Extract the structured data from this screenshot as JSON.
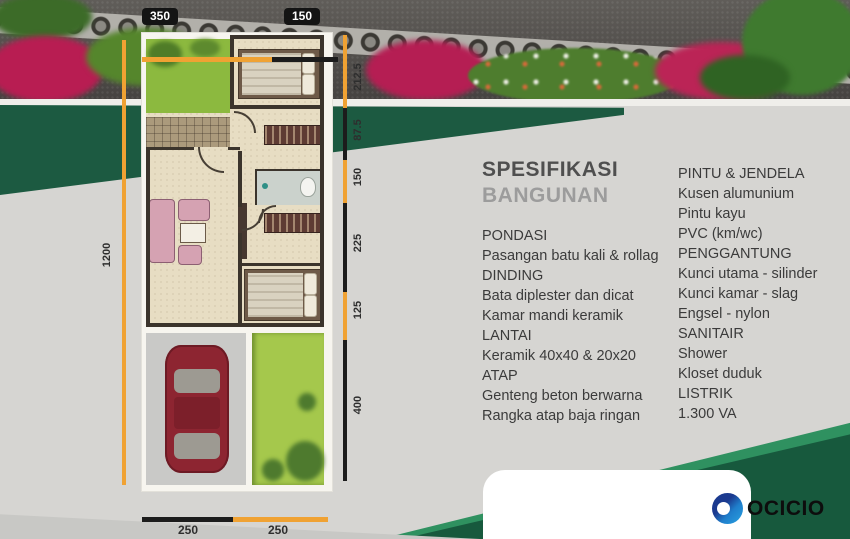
{
  "plan": {
    "dims": {
      "top": [
        "350",
        "150"
      ],
      "right": [
        "212.5",
        "87.5",
        "150",
        "225",
        "125",
        "400"
      ],
      "left": "1200",
      "bottom": [
        "250",
        "250"
      ]
    }
  },
  "specs": {
    "title": "SPESIFIKASI",
    "subtitle": "BANGUNAN",
    "left_items": [
      "PONDASI",
      "Pasangan batu kali & rollag",
      "DINDING",
      "Bata diplester dan dicat",
      "Kamar mandi keramik",
      "LANTAI",
      "Keramik 40x40 & 20x20",
      "ATAP",
      "Genteng beton berwarna",
      "Rangka atap baja ringan"
    ],
    "right_items": [
      "PINTU & JENDELA",
      "Kusen alumunium",
      "Pintu kayu",
      "PVC  (km/wc)",
      "PENGGANTUNG",
      "Kunci utama - silinder",
      "Kunci kamar - slag",
      "Engsel - nylon",
      "SANITAIR",
      "Shower",
      "Kloset duduk",
      "LISTRIK",
      "1.300 VA"
    ]
  },
  "logo": {
    "text": "OCICIO"
  },
  "colors": {
    "dimension_orange": "#f0a233",
    "dimension_black": "#1c1c1c",
    "wedge_green_dark": "#17593d",
    "wedge_green_light": "#2f9160",
    "background_gray": "#d6d5d2",
    "logo_blue_dark": "#1b3a8f",
    "logo_blue_light": "#29a3e2"
  }
}
